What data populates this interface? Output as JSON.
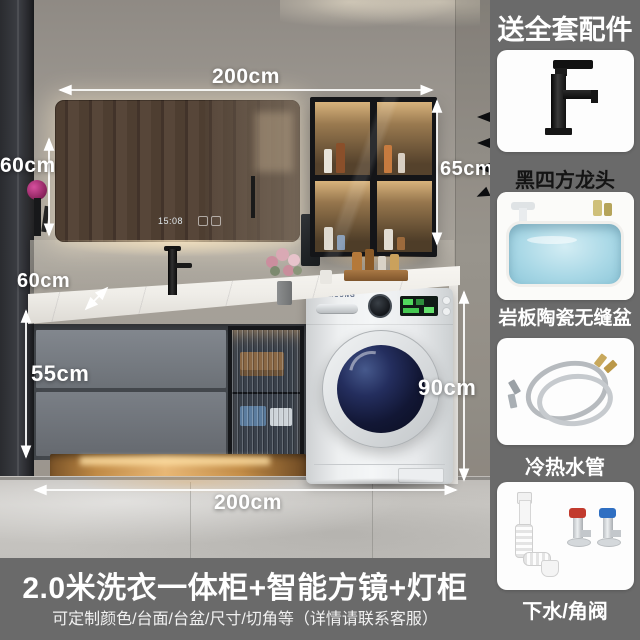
{
  "sidebar": {
    "header": "送全套配件",
    "items": [
      {
        "label": "黑四方龙头",
        "icon": "black-square-faucet"
      },
      {
        "label": "岩板陶瓷无缝盆",
        "icon": "slate-ceramic-seamless-basin"
      },
      {
        "label": "冷热水管",
        "icon": "hot-cold-water-hoses"
      },
      {
        "label": "下水/角阀",
        "icon": "drain-pipe-angle-valves"
      }
    ]
  },
  "banner": {
    "title": "2.0米洗衣一体柜+智能方镜+灯柜",
    "subtitle": "可定制颜色/台面/台盆/尺寸/切角等（详情请联系客服）"
  },
  "dimensions": {
    "top_width": "200cm",
    "mirror_height": "60cm",
    "side_cabinet_height": "65cm",
    "counter_depth": "60cm",
    "vanity_height": "55cm",
    "washer_space_height": "90cm",
    "bottom_width": "200cm"
  },
  "scene": {
    "mirror_clock": "15:08",
    "washer_brand": "SAMSUNG"
  },
  "colors": {
    "background_gray": "#6a6a6a",
    "annotation_text": "#ffffff",
    "first_label_text": "#141414",
    "valve_hot": "#c23b2e",
    "valve_cold": "#2f6fc2",
    "plinth_glow": "#e8b877"
  }
}
